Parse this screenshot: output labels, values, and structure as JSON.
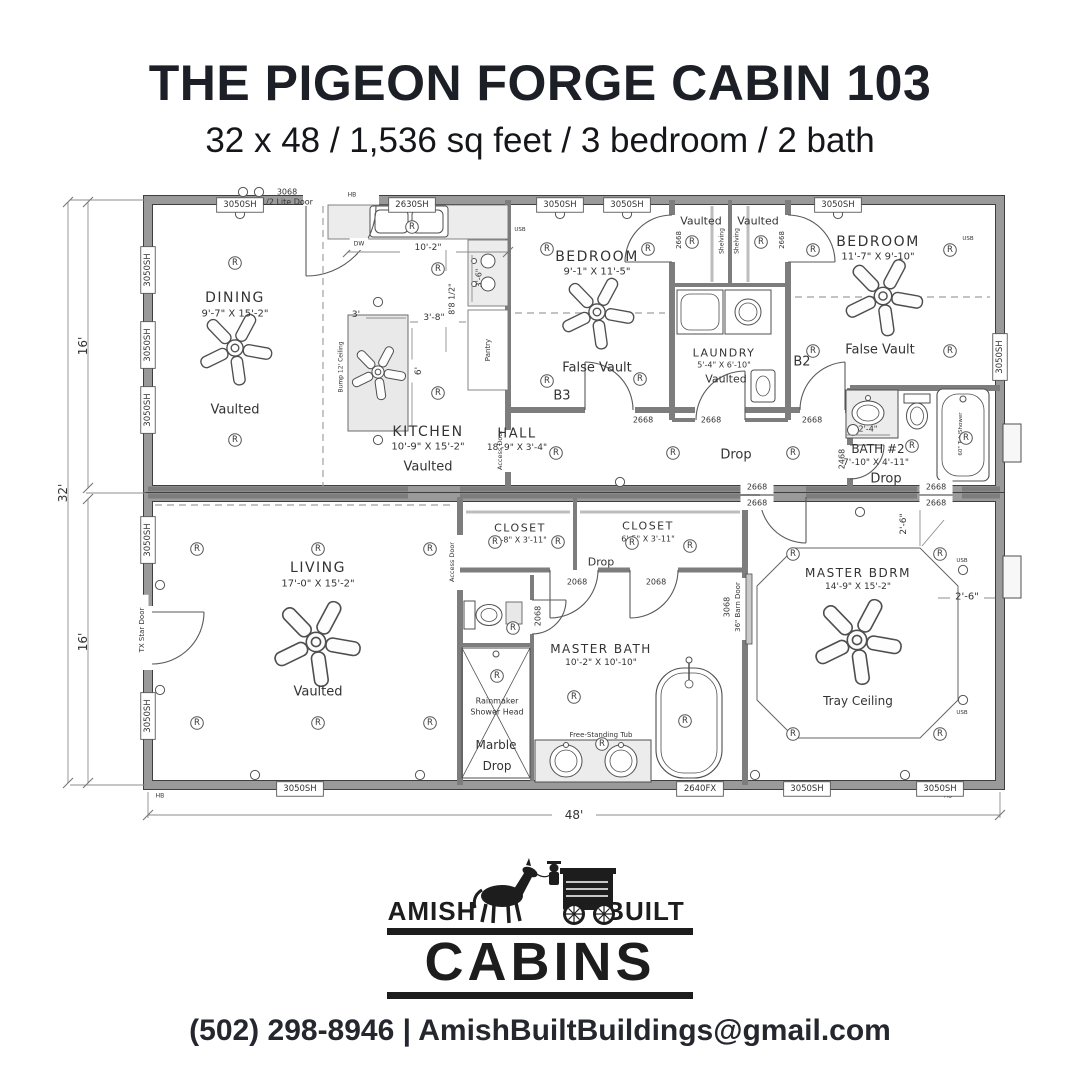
{
  "header": {
    "title": "THE PIGEON FORGE CABIN 103",
    "subtitle": "32 x 48 / 1,536 sq feet / 3 bedroom / 2 bath"
  },
  "footer": {
    "brand_left": "AMISH",
    "brand_right": "BUILT",
    "brand_main": "CABINS",
    "contact": "(502) 298-8946 | AmishBuiltBuildings@gmail.com"
  },
  "plan": {
    "light_symbol": "R",
    "labels": [
      {
        "t": "DINING",
        "x": 235,
        "y": 298,
        "s": 14,
        "k": 1
      },
      {
        "t": "9'-7\" X 15'-2\"",
        "x": 235,
        "y": 314,
        "s": 10
      },
      {
        "t": "Vaulted",
        "x": 235,
        "y": 410,
        "s": 13
      },
      {
        "t": "KITCHEN",
        "x": 428,
        "y": 432,
        "s": 14,
        "k": 1
      },
      {
        "t": "10'-9\" X 15'-2\"",
        "x": 428,
        "y": 447,
        "s": 10
      },
      {
        "t": "Vaulted",
        "x": 428,
        "y": 467,
        "s": 13
      },
      {
        "t": "BEDROOM",
        "x": 597,
        "y": 257,
        "s": 14,
        "k": 1
      },
      {
        "t": "9'-1\" X 11'-5\"",
        "x": 597,
        "y": 272,
        "s": 10
      },
      {
        "t": "False Vault",
        "x": 597,
        "y": 368,
        "s": 13
      },
      {
        "t": "B3",
        "x": 562,
        "y": 396,
        "s": 13
      },
      {
        "t": "Vaulted",
        "x": 701,
        "y": 221,
        "s": 11
      },
      {
        "t": "Vaulted",
        "x": 758,
        "y": 221,
        "s": 11
      },
      {
        "t": "LAUNDRY",
        "x": 724,
        "y": 353,
        "s": 11,
        "k": 1
      },
      {
        "t": "5'-4\" X 6'-10\"",
        "x": 724,
        "y": 365,
        "s": 8
      },
      {
        "t": "Vaulted",
        "x": 726,
        "y": 379,
        "s": 11
      },
      {
        "t": "BEDROOM",
        "x": 878,
        "y": 242,
        "s": 14,
        "k": 1
      },
      {
        "t": "11'-7\" X 9'-10\"",
        "x": 878,
        "y": 257,
        "s": 10
      },
      {
        "t": "False Vault",
        "x": 880,
        "y": 350,
        "s": 13
      },
      {
        "t": "B2",
        "x": 802,
        "y": 362,
        "s": 13
      },
      {
        "t": "HALL",
        "x": 517,
        "y": 434,
        "s": 13,
        "k": 1
      },
      {
        "t": "18'-9\" X 3'-4\"",
        "x": 517,
        "y": 448,
        "s": 9
      },
      {
        "t": "Drop",
        "x": 736,
        "y": 455,
        "s": 13
      },
      {
        "t": "BATH #2",
        "x": 878,
        "y": 449,
        "s": 12
      },
      {
        "t": "7'-10\" X 4'-11\"",
        "x": 876,
        "y": 463,
        "s": 9
      },
      {
        "t": "Drop",
        "x": 886,
        "y": 479,
        "s": 13
      },
      {
        "t": "LIVING",
        "x": 318,
        "y": 568,
        "s": 14,
        "k": 1
      },
      {
        "t": "17'-0\" X 15'-2\"",
        "x": 318,
        "y": 584,
        "s": 10
      },
      {
        "t": "Vaulted",
        "x": 318,
        "y": 692,
        "s": 13
      },
      {
        "t": "CLOSET",
        "x": 520,
        "y": 528,
        "s": 11,
        "k": 1
      },
      {
        "t": "7'-8\" X 3'-11\"",
        "x": 520,
        "y": 540,
        "s": 8
      },
      {
        "t": "CLOSET",
        "x": 648,
        "y": 526,
        "s": 11,
        "k": 1
      },
      {
        "t": "6'-5\" X 3'-11\"",
        "x": 648,
        "y": 539,
        "s": 8
      },
      {
        "t": "Drop",
        "x": 601,
        "y": 562,
        "s": 11
      },
      {
        "t": "MASTER BATH",
        "x": 601,
        "y": 649,
        "s": 12,
        "k": 1
      },
      {
        "t": "10'-2\" X 10'-10\"",
        "x": 601,
        "y": 663,
        "s": 9
      },
      {
        "t": "Rainmaker",
        "x": 497,
        "y": 701,
        "s": 8
      },
      {
        "t": "Shower Head",
        "x": 497,
        "y": 712,
        "s": 8
      },
      {
        "t": "Marble",
        "x": 496,
        "y": 745,
        "s": 12
      },
      {
        "t": "Drop",
        "x": 497,
        "y": 766,
        "s": 12
      },
      {
        "t": "Free-Standing Tub",
        "x": 601,
        "y": 735,
        "s": 7
      },
      {
        "t": "MASTER BDRM",
        "x": 858,
        "y": 573,
        "s": 12,
        "k": 1
      },
      {
        "t": "14'-9\" X 15'-2\"",
        "x": 858,
        "y": 587,
        "s": 9
      },
      {
        "t": "Tray Ceiling",
        "x": 858,
        "y": 701,
        "s": 12
      },
      {
        "t": "3068",
        "x": 287,
        "y": 192,
        "s": 8
      },
      {
        "t": "1/2 Lite Door",
        "x": 287,
        "y": 202,
        "s": 8
      },
      {
        "t": "2668",
        "x": 643,
        "y": 420,
        "s": 8
      },
      {
        "t": "2668",
        "x": 711,
        "y": 420,
        "s": 8
      },
      {
        "t": "2668",
        "x": 812,
        "y": 420,
        "s": 8
      },
      {
        "t": "2668",
        "x": 757,
        "y": 487,
        "s": 8,
        "b": 2
      },
      {
        "t": "2668",
        "x": 757,
        "y": 503,
        "s": 8,
        "b": 2
      },
      {
        "t": "2668",
        "x": 936,
        "y": 487,
        "s": 8,
        "b": 2
      },
      {
        "t": "2668",
        "x": 936,
        "y": 503,
        "s": 8,
        "b": 2
      },
      {
        "t": "2068",
        "x": 577,
        "y": 582,
        "s": 8
      },
      {
        "t": "2068",
        "x": 656,
        "y": 582,
        "s": 8
      },
      {
        "t": "2468",
        "x": 842,
        "y": 459,
        "s": 8,
        "v": 1
      },
      {
        "t": "2068",
        "x": 538,
        "y": 616,
        "s": 8,
        "v": 1
      },
      {
        "t": "3068",
        "x": 727,
        "y": 607,
        "s": 8,
        "v": 1
      },
      {
        "t": "36\" Barn Door",
        "x": 738,
        "y": 607,
        "s": 7,
        "v": 1
      },
      {
        "t": "2668",
        "x": 679,
        "y": 240,
        "s": 7,
        "v": 1
      },
      {
        "t": "2668",
        "x": 782,
        "y": 240,
        "s": 7,
        "v": 1
      },
      {
        "t": "Shelving",
        "x": 722,
        "y": 241,
        "s": 6,
        "v": 1
      },
      {
        "t": "Shelving",
        "x": 737,
        "y": 241,
        "s": 6,
        "v": 1
      },
      {
        "t": "Pantry",
        "x": 488,
        "y": 350,
        "s": 7,
        "v": 1
      },
      {
        "t": "Access Door",
        "x": 500,
        "y": 450,
        "s": 6.5,
        "v": 1
      },
      {
        "t": "Access Door",
        "x": 452,
        "y": 562,
        "s": 6.5,
        "v": 1
      },
      {
        "t": "TX Star Door",
        "x": 142,
        "y": 630,
        "s": 7,
        "v": 1,
        "b": 2
      },
      {
        "t": "Bump 12' Ceiling",
        "x": 341,
        "y": 367,
        "s": 6,
        "v": 1
      },
      {
        "t": "60\" Tub/Shower",
        "x": 961,
        "y": 434,
        "s": 5.5,
        "v": 1
      },
      {
        "t": "8'8 1/2\"",
        "x": 452,
        "y": 299,
        "s": 8,
        "v": 1,
        "b": 2
      },
      {
        "t": "3'-6\"",
        "x": 479,
        "y": 278,
        "s": 8,
        "v": 1
      },
      {
        "t": "6'",
        "x": 419,
        "y": 371,
        "s": 9,
        "v": 1,
        "b": 2
      },
      {
        "t": "2'-6\"",
        "x": 904,
        "y": 524,
        "s": 9,
        "v": 1
      },
      {
        "t": "10'-2\"",
        "x": 428,
        "y": 248,
        "s": 9
      },
      {
        "t": "3'-8\"",
        "x": 434,
        "y": 318,
        "s": 9
      },
      {
        "t": "3'",
        "x": 356,
        "y": 315,
        "s": 9
      },
      {
        "t": "2'-4\"",
        "x": 868,
        "y": 429,
        "s": 8
      },
      {
        "t": "2'-6\"",
        "x": 967,
        "y": 597,
        "s": 10
      },
      {
        "t": "DW",
        "x": 359,
        "y": 244,
        "s": 6,
        "b": 2
      },
      {
        "t": "HB",
        "x": 352,
        "y": 195,
        "s": 6,
        "b": 2
      },
      {
        "t": "HB",
        "x": 160,
        "y": 796,
        "s": 6
      },
      {
        "t": "HB",
        "x": 948,
        "y": 796,
        "s": 6
      },
      {
        "t": "USB",
        "x": 520,
        "y": 230,
        "s": 5.5
      },
      {
        "t": "USB",
        "x": 968,
        "y": 239,
        "s": 5.5
      },
      {
        "t": "USB",
        "x": 962,
        "y": 561,
        "s": 5.5
      },
      {
        "t": "USB",
        "x": 962,
        "y": 713,
        "s": 5.5
      },
      {
        "t": "16'",
        "x": 83,
        "y": 346,
        "s": 12,
        "v": 1
      },
      {
        "t": "32'",
        "x": 63,
        "y": 493,
        "s": 12,
        "v": 1
      },
      {
        "t": "16'",
        "x": 83,
        "y": 642,
        "s": 12,
        "v": 1
      },
      {
        "t": "48'",
        "x": 574,
        "y": 815,
        "s": 12,
        "b": 2
      },
      {
        "t": "3050SH",
        "x": 240,
        "y": 205,
        "s": 8.5,
        "b": 1
      },
      {
        "t": "2630SH",
        "x": 412,
        "y": 205,
        "s": 8.5,
        "b": 1
      },
      {
        "t": "3050SH",
        "x": 560,
        "y": 205,
        "s": 8.5,
        "b": 1
      },
      {
        "t": "3050SH",
        "x": 627,
        "y": 205,
        "s": 8.5,
        "b": 1
      },
      {
        "t": "3050SH",
        "x": 838,
        "y": 205,
        "s": 8.5,
        "b": 1
      },
      {
        "t": "3050SH",
        "x": 148,
        "y": 270,
        "s": 8.5,
        "b": 1,
        "v": 1
      },
      {
        "t": "3050SH",
        "x": 148,
        "y": 345,
        "s": 8.5,
        "b": 1,
        "v": 1
      },
      {
        "t": "3050SH",
        "x": 148,
        "y": 410,
        "s": 8.5,
        "b": 1,
        "v": 1
      },
      {
        "t": "3050SH",
        "x": 148,
        "y": 540,
        "s": 8.5,
        "b": 1,
        "v": 1
      },
      {
        "t": "3050SH",
        "x": 148,
        "y": 716,
        "s": 8.5,
        "b": 1,
        "v": 1
      },
      {
        "t": "3050SH",
        "x": 1000,
        "y": 357,
        "s": 8.5,
        "b": 1,
        "v": 1
      },
      {
        "t": "3050SH",
        "x": 300,
        "y": 789,
        "s": 8.5,
        "b": 1
      },
      {
        "t": "2640FX",
        "x": 700,
        "y": 789,
        "s": 8.5,
        "b": 1
      },
      {
        "t": "3050SH",
        "x": 807,
        "y": 789,
        "s": 8.5,
        "b": 1
      },
      {
        "t": "3050SH",
        "x": 940,
        "y": 789,
        "s": 8.5,
        "b": 1
      }
    ],
    "lights": [
      [
        235,
        263
      ],
      [
        235,
        440
      ],
      [
        438,
        269
      ],
      [
        438,
        393
      ],
      [
        547,
        249
      ],
      [
        648,
        249
      ],
      [
        547,
        381
      ],
      [
        640,
        379
      ],
      [
        692,
        242
      ],
      [
        761,
        242
      ],
      [
        813,
        250
      ],
      [
        950,
        250
      ],
      [
        813,
        351
      ],
      [
        950,
        351
      ],
      [
        556,
        453
      ],
      [
        673,
        453
      ],
      [
        793,
        453
      ],
      [
        912,
        446
      ],
      [
        966,
        438
      ],
      [
        412,
        227
      ],
      [
        197,
        549
      ],
      [
        318,
        549
      ],
      [
        430,
        549
      ],
      [
        197,
        723
      ],
      [
        318,
        723
      ],
      [
        430,
        723
      ],
      [
        495,
        542
      ],
      [
        558,
        542
      ],
      [
        632,
        543
      ],
      [
        690,
        546
      ],
      [
        513,
        628
      ],
      [
        497,
        676
      ],
      [
        574,
        697
      ],
      [
        602,
        744
      ],
      [
        685,
        721
      ],
      [
        793,
        554
      ],
      [
        940,
        554
      ],
      [
        793,
        734
      ],
      [
        940,
        734
      ]
    ],
    "outlets": [
      [
        243,
        192
      ],
      [
        259,
        192
      ],
      [
        240,
        214
      ],
      [
        560,
        214
      ],
      [
        627,
        214
      ],
      [
        838,
        214
      ],
      [
        378,
        302
      ],
      [
        378,
        440
      ],
      [
        160,
        585
      ],
      [
        160,
        690
      ],
      [
        255,
        775
      ],
      [
        420,
        775
      ],
      [
        755,
        775
      ],
      [
        905,
        775
      ],
      [
        963,
        570
      ],
      [
        963,
        700
      ],
      [
        620,
        482
      ],
      [
        860,
        512
      ]
    ]
  }
}
